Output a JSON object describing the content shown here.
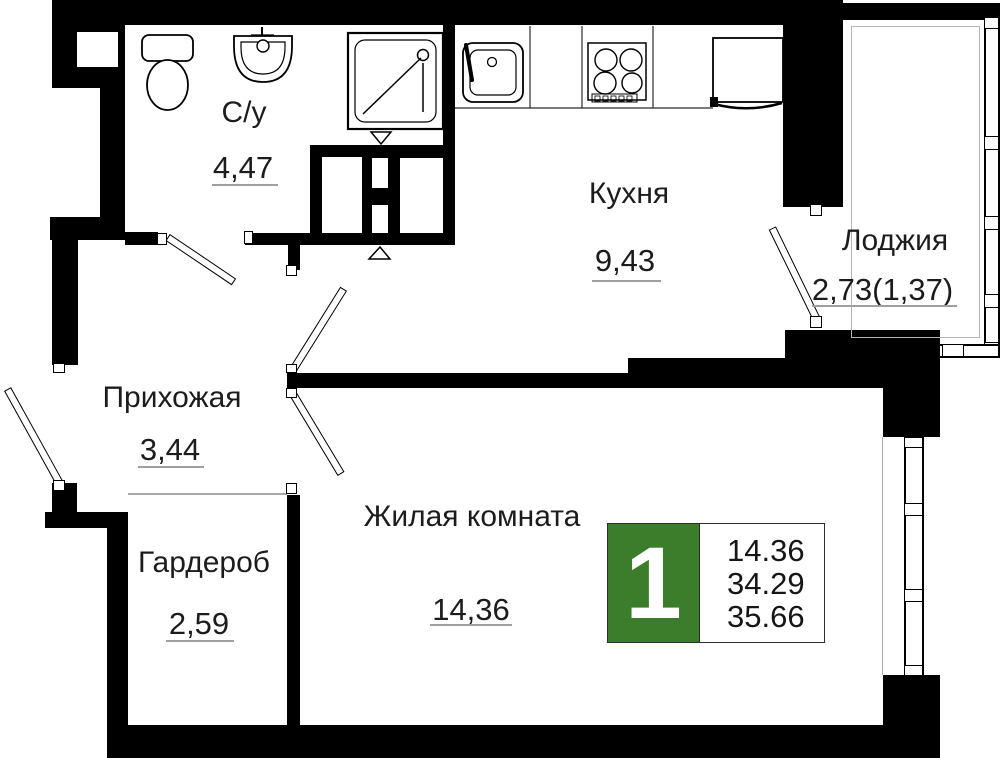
{
  "plan_title": "apartment floor plan",
  "colors": {
    "wall": "#000000",
    "badge_green": "#3c7d2b",
    "underline": "#9f9f9f"
  },
  "rooms": {
    "bathroom": {
      "label": "С/у",
      "area": "4,47"
    },
    "kitchen": {
      "label": "Кухня",
      "area": "9,43"
    },
    "loggia": {
      "label": "Лоджия",
      "area": "2,73(1,37)"
    },
    "hallway": {
      "label": "Прихожая",
      "area": "3,44"
    },
    "wardrobe": {
      "label": "Гардероб",
      "area": "2,59"
    },
    "living_room": {
      "label": "Жилая комната",
      "area": "14,36"
    }
  },
  "badge": {
    "rooms_count": "1",
    "living_area": "14.36",
    "apartment_area": "34.29",
    "total_area": "35.66"
  },
  "fixtures": [
    "toilet",
    "bathroom-sink",
    "shower",
    "kitchen-sink",
    "stove",
    "fridge"
  ]
}
